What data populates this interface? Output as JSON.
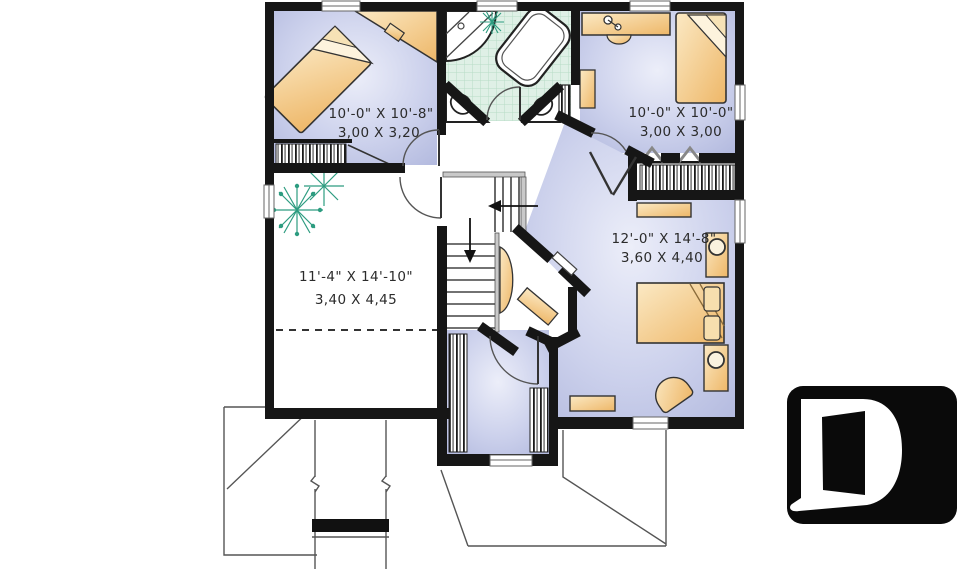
{
  "plan": {
    "type": "second-floor-plan",
    "rooms": {
      "bedroom1": {
        "imperial": "10'-0\" X 10'-8\"",
        "metric": "3,00 X 3,20"
      },
      "bedroom2": {
        "imperial": "10'-0\" X 10'-0\"",
        "metric": "3,00 X 3,00"
      },
      "master_bedroom": {
        "imperial": "12'-0\" X 14'-8\"",
        "metric": "3,60 X 4,40"
      },
      "bonus_room": {
        "imperial": "11'-4\" X 14'-10\"",
        "metric": "3,40 X 4,45"
      }
    },
    "colors": {
      "wall": "#161616",
      "bedroom_floor": "#b6bcdf",
      "bedroom_floor_light": "#e9ecf8",
      "furniture_tan": "#eeb768",
      "furniture_tan_light": "#fbe9c4",
      "bath_tile": "#dff0e6",
      "bath_tile_line": "#b7dcc6",
      "plant_green": "#2d9c80",
      "roof_line": "#555555",
      "logo_bg": "#0a0a0a",
      "logo_fg": "#ffffff"
    },
    "logo": {
      "letter": "D"
    }
  }
}
